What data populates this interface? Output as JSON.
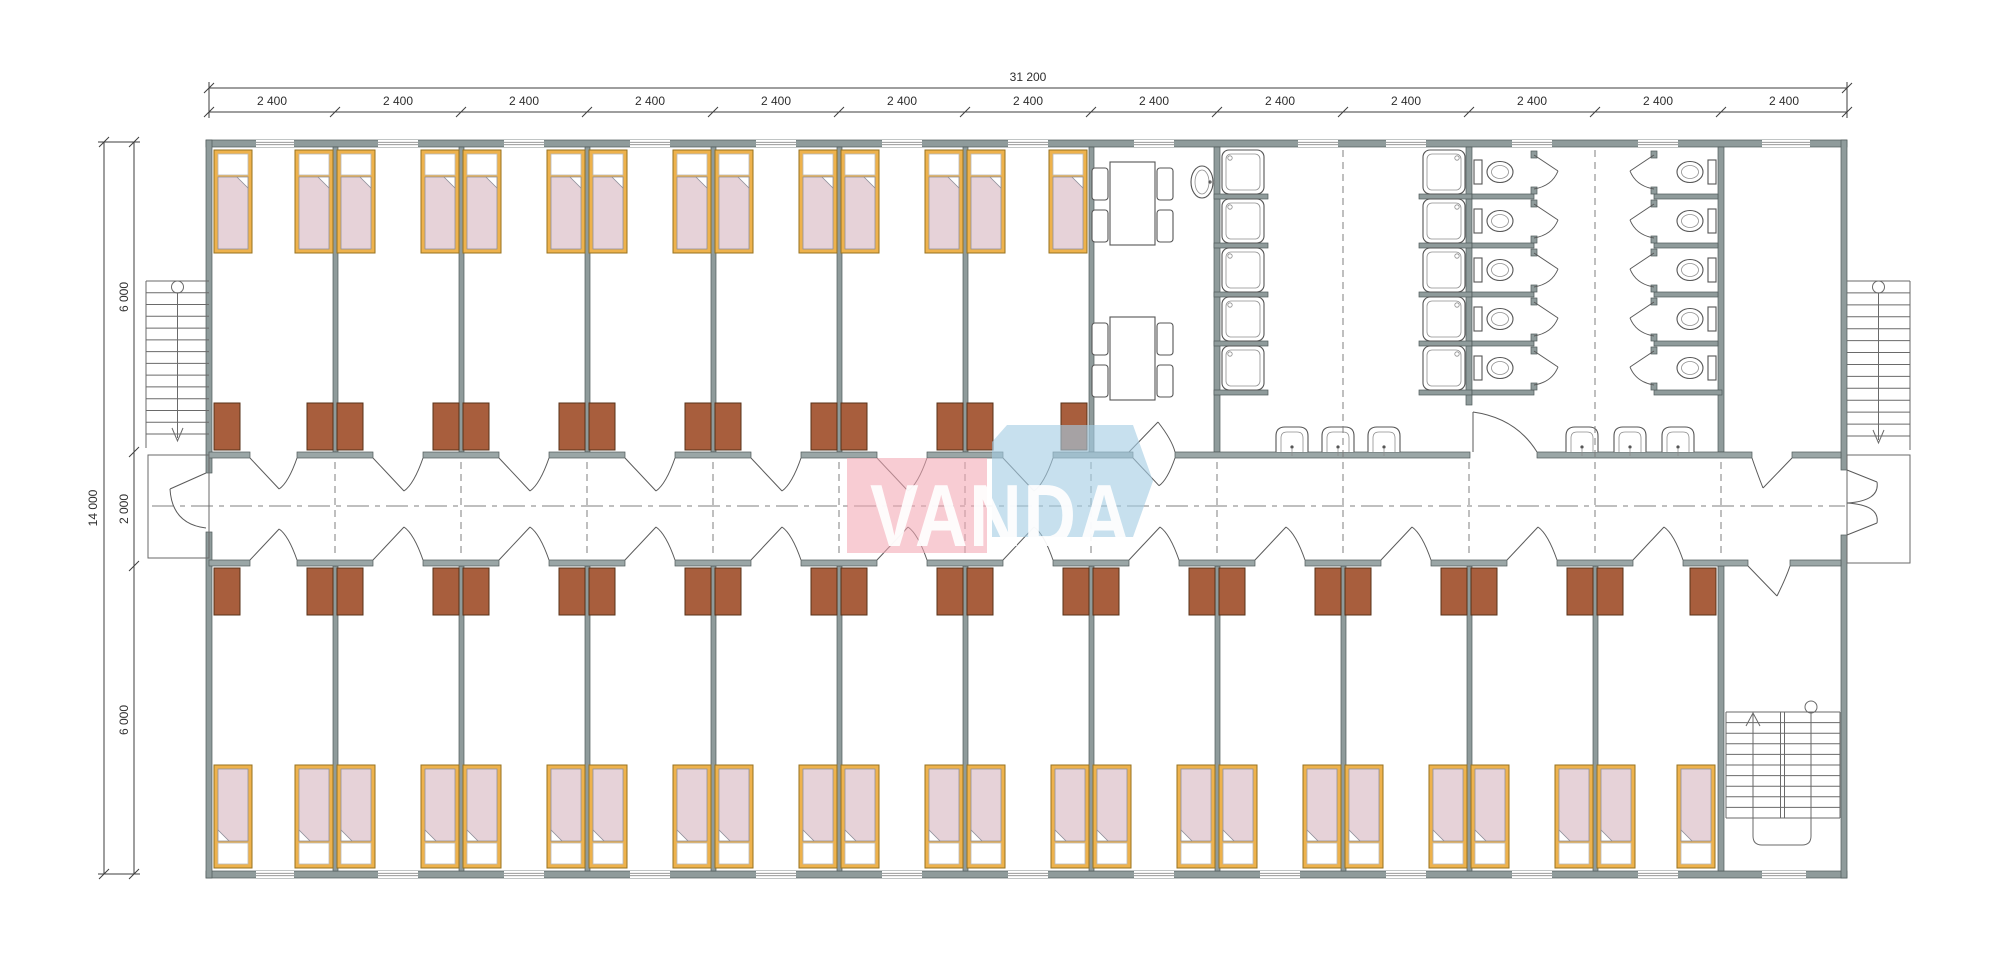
{
  "drawing": {
    "type": "architectural-floor-plan",
    "subject": "dormitory modular building with central corridor"
  },
  "logo": {
    "text": "VANDA",
    "pink_color": "#f3a7b4",
    "blue_color": "#a5cde4",
    "text_color": "#ffffff"
  },
  "dimensions": {
    "overall_width": "31 200",
    "module_width_labels": [
      "2 400",
      "2 400",
      "2 400",
      "2 400",
      "2 400",
      "2 400",
      "2 400",
      "2 400",
      "2 400",
      "2 400",
      "2 400",
      "2 400",
      "2 400"
    ],
    "overall_height": "14 000",
    "height_segments": [
      "6 000",
      "2 000",
      "6 000"
    ]
  },
  "inventory": {
    "bedrooms_top": 7,
    "bedrooms_bottom": 12,
    "beds": 38,
    "wardrobes": 38,
    "shower_stalls": 10,
    "toilet_stalls": 10,
    "wall_basins": 6,
    "oval_basin": 1,
    "dining_tables": 2,
    "chairs": 8,
    "staircases": 3
  },
  "colors": {
    "wall": "#8f9b9b",
    "bed_frame": "#eeb24c",
    "mattress": "#e6d2d8",
    "wardrobe": "#a85e3d",
    "lines": "#555555",
    "dimension": "#3d3d3d"
  },
  "plan": {
    "walls": {
      "ext": [
        [
          206,
          140,
          1641,
          7
        ],
        [
          206,
          871,
          1641,
          7
        ],
        [
          206,
          140,
          6,
          333
        ],
        [
          206,
          532,
          6,
          346
        ],
        [
          1841,
          140,
          6,
          330
        ],
        [
          1841,
          535,
          6,
          343
        ]
      ],
      "partitions": [
        [
          333,
          147,
          5,
          305
        ],
        [
          459,
          147,
          5,
          305
        ],
        [
          585,
          147,
          5,
          305
        ],
        [
          711,
          147,
          5,
          305
        ],
        [
          837,
          147,
          5,
          305
        ],
        [
          963,
          147,
          5,
          305
        ],
        [
          1089,
          147,
          5,
          305
        ],
        [
          1214,
          147,
          6,
          305
        ],
        [
          1466,
          147,
          6,
          258
        ],
        [
          1718,
          147,
          6,
          305
        ],
        [
          333,
          566,
          5,
          305
        ],
        [
          459,
          566,
          5,
          305
        ],
        [
          585,
          566,
          5,
          305
        ],
        [
          711,
          566,
          5,
          305
        ],
        [
          837,
          566,
          5,
          305
        ],
        [
          963,
          566,
          5,
          305
        ],
        [
          1089,
          566,
          5,
          305
        ],
        [
          1215,
          566,
          5,
          305
        ],
        [
          1341,
          566,
          5,
          305
        ],
        [
          1467,
          566,
          5,
          305
        ],
        [
          1593,
          566,
          5,
          305
        ],
        [
          1718,
          566,
          6,
          305
        ]
      ],
      "stall_bottoms": [
        [
          1214,
          390,
          54,
          5
        ],
        [
          1419,
          390,
          53,
          5
        ],
        [
          1472,
          390,
          62,
          5
        ],
        [
          1654,
          390,
          68,
          5
        ]
      ],
      "corr_top_y": 452,
      "corr_bot_y": 560,
      "wall_h": 6,
      "corr_top_segments": [
        [
          209,
          250
        ],
        [
          297,
          373
        ],
        [
          423,
          499
        ],
        [
          549,
          625
        ],
        [
          675,
          751
        ],
        [
          801,
          877
        ],
        [
          927,
          1003
        ],
        [
          1053,
          1133
        ],
        [
          1175,
          1470
        ],
        [
          1537,
          1752
        ],
        [
          1792,
          1841
        ]
      ],
      "corr_bot_segments": [
        [
          209,
          250
        ],
        [
          297,
          373
        ],
        [
          423,
          499
        ],
        [
          549,
          625
        ],
        [
          675,
          751
        ],
        [
          801,
          877
        ],
        [
          927,
          1003
        ],
        [
          1053,
          1129
        ],
        [
          1179,
          1255
        ],
        [
          1305,
          1381
        ],
        [
          1431,
          1507
        ],
        [
          1557,
          1633
        ],
        [
          1683,
          1748
        ],
        [
          1790,
          1841
        ]
      ]
    },
    "windows": {
      "top": [
        [
          256,
          294
        ],
        [
          378,
          418
        ],
        [
          504,
          544
        ],
        [
          630,
          670
        ],
        [
          756,
          796
        ],
        [
          882,
          922
        ],
        [
          1008,
          1048
        ],
        [
          1134,
          1174
        ],
        [
          1298,
          1338
        ],
        [
          1386,
          1426
        ],
        [
          1512,
          1552
        ],
        [
          1638,
          1678
        ],
        [
          1762,
          1810
        ]
      ],
      "bottom": [
        [
          256,
          294
        ],
        [
          378,
          418
        ],
        [
          504,
          544
        ],
        [
          630,
          670
        ],
        [
          756,
          796
        ],
        [
          882,
          922
        ],
        [
          1008,
          1048
        ],
        [
          1134,
          1174
        ],
        [
          1260,
          1300
        ],
        [
          1386,
          1426
        ],
        [
          1512,
          1552
        ],
        [
          1638,
          1678
        ],
        [
          1762,
          1806
        ]
      ]
    },
    "beds": {
      "w": 38,
      "h": 103,
      "top_y": 150,
      "top_x": [
        214,
        295,
        337,
        421,
        463,
        547,
        589,
        673,
        715,
        799,
        841,
        925,
        967,
        1049
      ],
      "bottom_y": 765,
      "bottom_x": [
        214,
        295,
        337,
        421,
        463,
        547,
        589,
        673,
        715,
        799,
        841,
        925,
        967,
        1051,
        1093,
        1177,
        1219,
        1303,
        1345,
        1429,
        1471,
        1555,
        1597,
        1677
      ]
    },
    "wardrobes": {
      "w": 26,
      "h": 47,
      "top_y": 403,
      "top_x": [
        214,
        307,
        337,
        433,
        463,
        559,
        589,
        685,
        715,
        811,
        841,
        937,
        967,
        1061
      ],
      "bottom_y": 568,
      "bottom_x": [
        214,
        307,
        337,
        433,
        463,
        559,
        589,
        685,
        715,
        811,
        841,
        937,
        967,
        1063,
        1093,
        1189,
        1219,
        1315,
        1345,
        1441,
        1471,
        1567,
        1597,
        1690
      ]
    },
    "doors": {
      "top_row": [
        [
          250,
          297
        ],
        [
          373,
          423
        ],
        [
          499,
          549
        ],
        [
          625,
          675
        ],
        [
          751,
          801
        ],
        [
          877,
          927
        ],
        [
          1003,
          1053
        ],
        [
          1133,
          1175
        ]
      ],
      "bottom_row": [
        [
          250,
          297
        ],
        [
          373,
          423
        ],
        [
          499,
          549
        ],
        [
          625,
          675
        ],
        [
          751,
          801
        ],
        [
          877,
          927
        ],
        [
          1003,
          1053
        ],
        [
          1129,
          1179
        ],
        [
          1255,
          1305
        ],
        [
          1381,
          1431
        ],
        [
          1507,
          1557
        ],
        [
          1633,
          1683
        ]
      ]
    },
    "dashes": {
      "corridor_x": [
        335,
        461,
        587,
        713,
        839,
        965,
        1091,
        1217,
        1469,
        1721
      ],
      "full_x": [
        1343,
        1595
      ],
      "corridor_y": [
        462,
        558
      ],
      "full_y": [
        150,
        558
      ],
      "centerline": {
        "y": 506,
        "x1": 152,
        "x2": 1845
      }
    },
    "showers": {
      "tray_w": 42,
      "tray_h": 44,
      "ys": [
        150,
        199,
        248,
        297,
        346
      ],
      "colA": {
        "x": 1222,
        "stub_x": 1214,
        "stub_w": 54,
        "drain": "left"
      },
      "colB": {
        "x": 1423,
        "stub_x": 1419,
        "stub_w": 53,
        "drain": "right"
      }
    },
    "toilets": {
      "ys": [
        150,
        199,
        248,
        297,
        346
      ],
      "stall_h": 44,
      "rowA": {
        "x1": 1472,
        "x2": 1534,
        "tank_x": 1474,
        "bowl_cx": 1500,
        "dir": 1
      },
      "rowB": {
        "x1": 1654,
        "x2": 1718,
        "tank_x": 1708,
        "bowl_cx": 1690,
        "dir": -1
      }
    },
    "basins": {
      "wall_y": 452,
      "centers": [
        1292,
        1338,
        1384,
        1582,
        1630,
        1678
      ]
    },
    "oval_basin": {
      "cx": 1202,
      "cy": 182
    },
    "dining": {
      "tables": [
        [
          1110,
          162
        ],
        [
          1110,
          317
        ]
      ],
      "table_w": 45,
      "table_h": 83,
      "chairs": [
        [
          1092,
          168
        ],
        [
          1092,
          210
        ],
        [
          1157,
          168
        ],
        [
          1157,
          210
        ],
        [
          1092,
          323
        ],
        [
          1092,
          365
        ],
        [
          1157,
          323
        ],
        [
          1157,
          365
        ]
      ],
      "chair_w": 16,
      "chair_h": 32
    },
    "stairs": {
      "left": {
        "x": 146,
        "y": 281,
        "w": 63,
        "h": 167,
        "treads": 13
      },
      "right": {
        "x": 1847,
        "y": 281,
        "w": 63,
        "h": 169,
        "treads": 13
      },
      "internal": {
        "x": 1726,
        "y": 712,
        "w": 114,
        "h": 106,
        "treads": 9
      }
    },
    "dims": {
      "line1_y": 88,
      "line2_y": 112,
      "leftA_x": 104,
      "leftB_x": 134,
      "x_ticks": [
        209,
        335,
        461,
        587,
        713,
        839,
        965,
        1091,
        1217,
        1343,
        1469,
        1595,
        1721,
        1847
      ],
      "y_ticks": [
        142,
        452,
        566,
        874
      ],
      "label_centers_x": [
        272,
        398,
        524,
        650,
        776,
        902,
        1028,
        1154,
        1280,
        1406,
        1532,
        1658,
        1784
      ]
    }
  }
}
